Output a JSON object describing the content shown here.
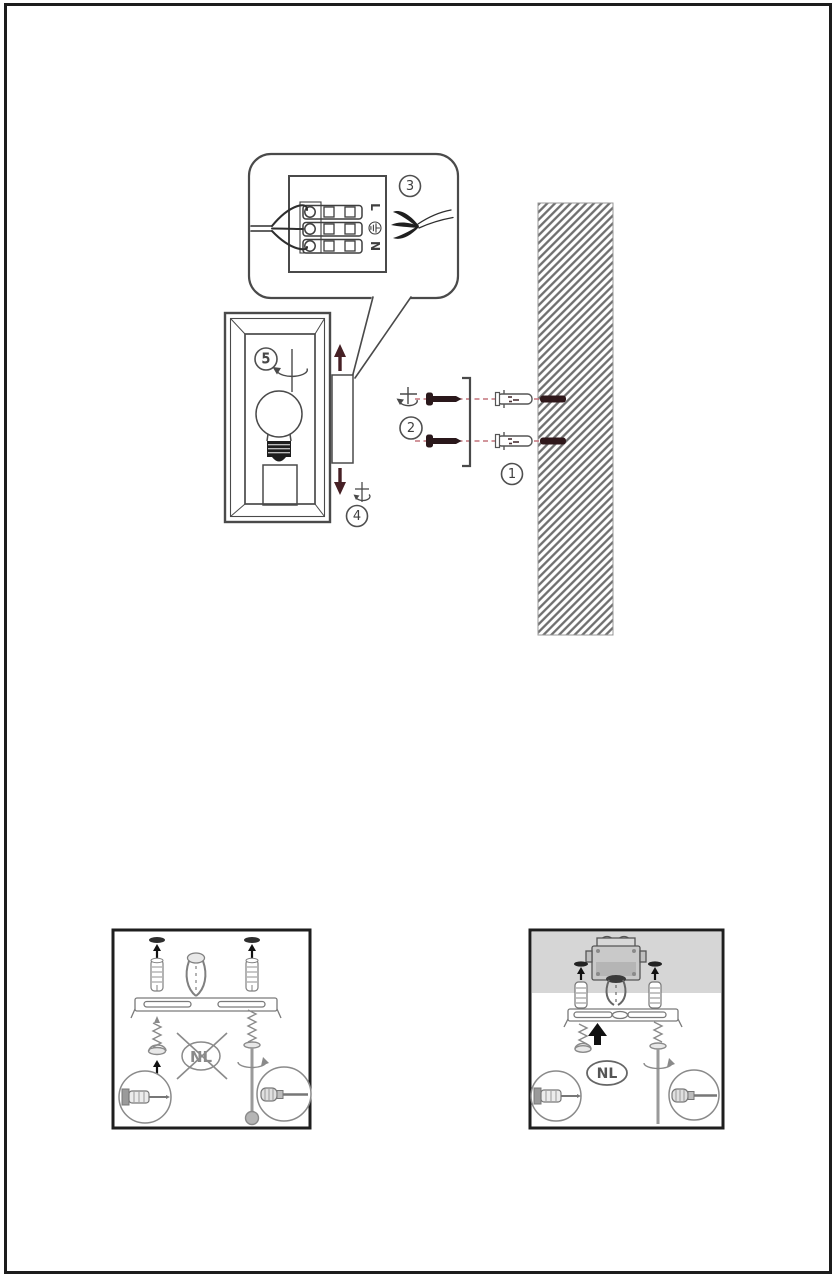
{
  "page": {
    "background": "#ffffff",
    "border_color": "#1c1c1c"
  },
  "colors": {
    "outline": "#4a4a4a",
    "soft_outline": "#858585",
    "accent_arrow": "#462025",
    "screw_dark": "#2a181b",
    "dashed_guide": "#c4747c",
    "wall_hatch": "#6e6e6e",
    "wall_hole": "#30191c",
    "ceiling_band": "#d6d6d6"
  },
  "icons": {
    "earth_ground": "⏚",
    "up_arrow": "↑",
    "down_arrow": "↓",
    "rotate_screw": "↻"
  },
  "main_illustration": {
    "step_labels": {
      "wall_plugs": "1",
      "screws": "2",
      "wiring": "3",
      "fixture": "4",
      "bulb": "5"
    },
    "terminal_block": {
      "live_label": "L",
      "neutral_label": "N"
    }
  },
  "country_detail_boxes": {
    "left": {
      "country_code": "NL",
      "crossed_out": true
    },
    "right": {
      "country_code": "NL",
      "crossed_out": false
    }
  }
}
